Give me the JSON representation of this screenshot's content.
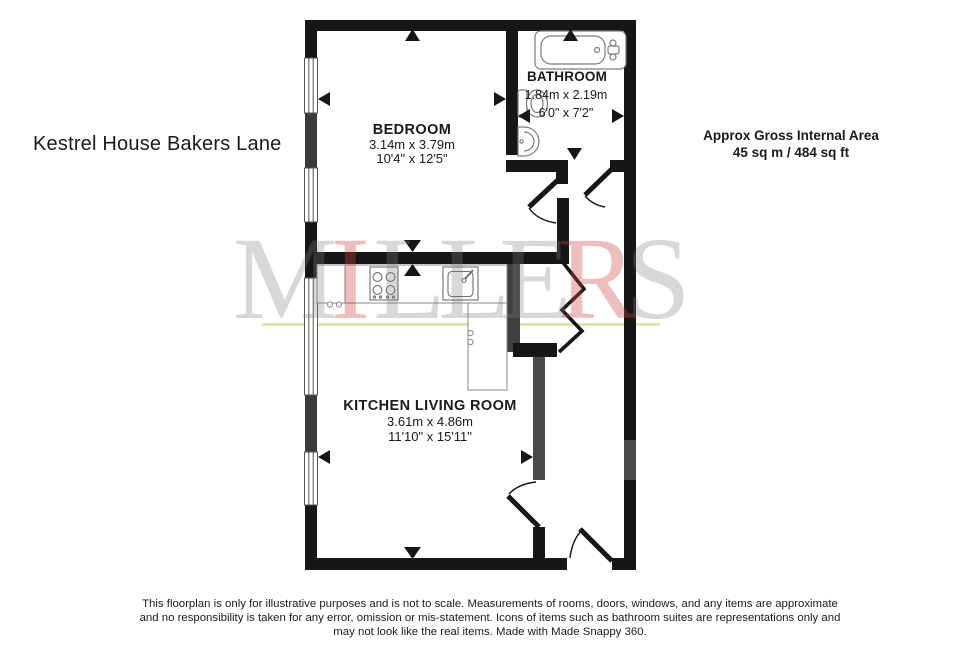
{
  "header": {
    "property_title": "Kestrel House Bakers Lane",
    "area_label": "Approx Gross Internal Area",
    "area_value": "45 sq m / 484 sq ft"
  },
  "rooms": {
    "bedroom": {
      "name": "BEDROOM",
      "metric": "3.14m x 3.79m",
      "imperial": "10'4\" x 12'5\""
    },
    "bathroom": {
      "name": "BATHROOM",
      "metric": "1.84m x 2.19m",
      "imperial": "6'0\" x 7'2\""
    },
    "kitchen": {
      "name": "KITCHEN LIVING ROOM",
      "metric": "3.61m x 4.86m",
      "imperial": "11'10\" x 15'11\""
    }
  },
  "watermark": {
    "letters": [
      {
        "char": "M",
        "fill": "rgba(125,125,125,0.30)"
      },
      {
        "char": "I",
        "fill": "rgba(205,65,65,0.35)"
      },
      {
        "char": "L",
        "fill": "rgba(125,125,125,0.30)"
      },
      {
        "char": "L",
        "fill": "rgba(125,125,125,0.30)"
      },
      {
        "char": "E",
        "fill": "rgba(125,125,125,0.30)"
      },
      {
        "char": "R",
        "fill": "rgba(205,65,65,0.35)"
      },
      {
        "char": "S",
        "fill": "rgba(125,125,125,0.30)"
      }
    ],
    "underline_color": "rgba(205,216,140,0.65)"
  },
  "disclaimer": {
    "line1": "This floorplan is only for illustrative purposes and is not to scale. Measurements of rooms, doors, windows, and any items are approximate",
    "line2": "and no responsibility is taken for any error, omission or mis-statement. Icons of items such as bathroom suites are representations only and",
    "line3": "may not look like the real items. Made with Made Snappy 360."
  },
  "colors": {
    "wall": "#161616",
    "wall_gray": "#3f3f3f",
    "wall_gray_light": "#4a4a4a",
    "fixture_stroke": "#888888",
    "text": "#1a1a1a"
  }
}
